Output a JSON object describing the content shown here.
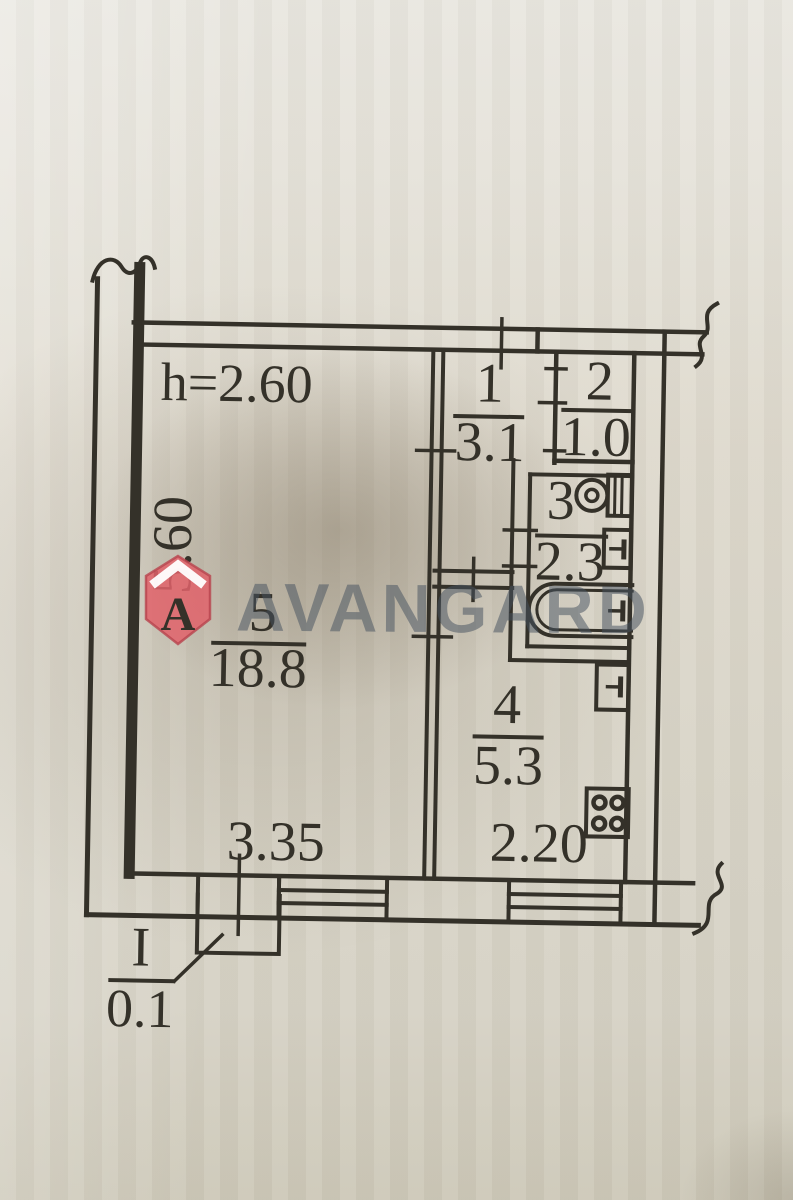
{
  "plan": {
    "height_label": "h=2.60",
    "rooms": [
      {
        "number": "1",
        "area": "3.1"
      },
      {
        "number": "2",
        "area": "1.0"
      },
      {
        "number": "3",
        "area": "2.3"
      },
      {
        "number": "4",
        "area": "5.3"
      },
      {
        "number": "5",
        "area": "18.8"
      }
    ],
    "dimensions": {
      "left_side": "5.60",
      "room5_width": "3.35",
      "kitchen_width": "2.20"
    },
    "section": {
      "label": "I",
      "area": "0.1"
    }
  },
  "watermark": {
    "brand": "AVANGARD",
    "logo_letter": "A"
  },
  "colors": {
    "ink": "#343129",
    "paper": "#ddd9cd",
    "logo_fill": "#e0616a",
    "logo_stroke": "#b8444e",
    "watermark_text": "rgba(70,82,95,0.52)"
  }
}
